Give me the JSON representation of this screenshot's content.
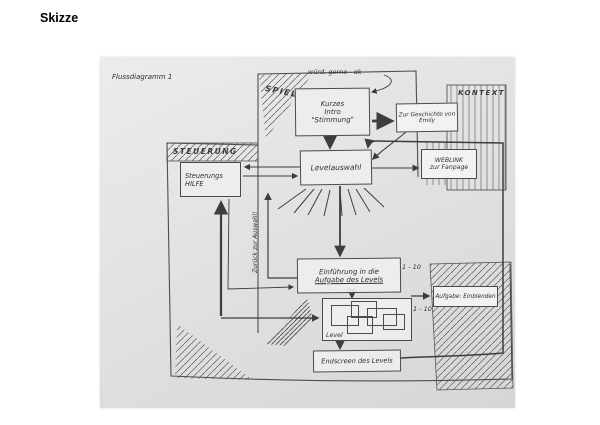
{
  "page": {
    "title": "Skizze"
  },
  "sketch": {
    "annotation_top": "Flussdiagramm 1",
    "note": "würd. gerne - ok",
    "sections": {
      "spiel": "SPIEL",
      "steuerung": "STEUERUNG",
      "kontext": "KONTEXT"
    },
    "nodes": {
      "intro": {
        "line1": "Kurzes",
        "line2": "Intro",
        "line3": "\"Stimmung\""
      },
      "geschichte": {
        "line1": "Zur Geschichte von",
        "line2": "Emily"
      },
      "weblink": {
        "line1": "WEBLINK",
        "line2": "zur Fanpage"
      },
      "levelauswahl": {
        "label": "Levelauswahl"
      },
      "steuerungshilfe": {
        "line1": "Steuerungs",
        "line2": "HILFE"
      },
      "einfuehrung": {
        "line1": "Einführung in die",
        "line2": "Aufgabe des Levels",
        "badge": "1 - 10"
      },
      "level": {
        "label": "Level",
        "badge": "1 - 10"
      },
      "endscreen": {
        "label": "Endscreen des Levels"
      },
      "aufgabe": {
        "label": "Aufgabe: Einblenden"
      }
    },
    "edge_labels": {
      "zurueck": "Zurück zur Auswahl!"
    }
  },
  "colors": {
    "pencil": "#3d3d3d",
    "paper": "#dedede"
  }
}
